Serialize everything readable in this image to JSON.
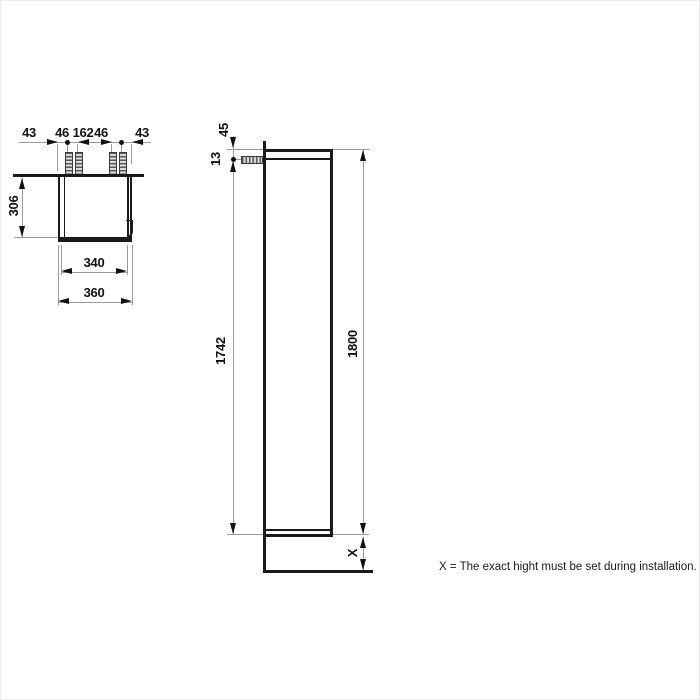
{
  "note": "X = The exact hight must be set during installation.",
  "colors": {
    "drawing_line": "#1a1a1a",
    "dimension_line": "#9a9a9a",
    "text": "#111111",
    "background": "#ffffff"
  },
  "top_view": {
    "dim_chain": [
      "43",
      "46",
      "162",
      "46",
      "43"
    ],
    "depth": "306",
    "inner_width": "340",
    "outer_width": "360"
  },
  "side_view": {
    "top_offset": "45",
    "bracket_offset": "13",
    "mount_height": "1742",
    "total_height": "1800",
    "floor_clearance": "X"
  }
}
